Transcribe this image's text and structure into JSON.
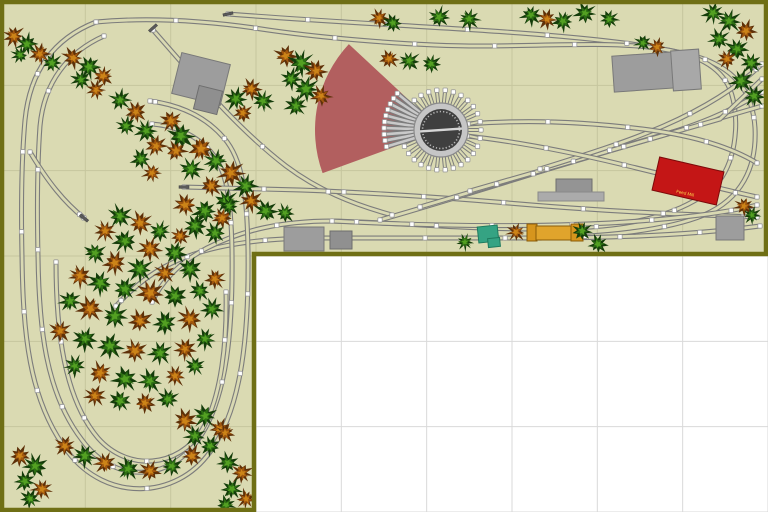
{
  "app": {
    "name": "Model railroad track plan with turntable and forest loop",
    "canvas": {
      "w": 768,
      "h": 512
    }
  },
  "board": {
    "fill": "#dadab2",
    "border_color": "#6f6f15",
    "grid_color": "#c6c69e",
    "outside_fill": "#ffffff",
    "outside_grid": "#d9d9d9",
    "cell": 85.333,
    "polygon": [
      [
        2,
        2
      ],
      [
        766,
        2
      ],
      [
        766,
        254
      ],
      [
        254,
        254
      ],
      [
        254,
        510
      ],
      [
        2,
        510
      ]
    ]
  },
  "track": {
    "rail": "#7c7c7c",
    "tie": "#d9d9b2",
    "stall_center": "#c9c9c9",
    "joint": {
      "size": 4.4,
      "fill": "#ffffff",
      "stroke": "#999999",
      "spacing": 80
    },
    "buffer_color": "#5a5a5a",
    "paths": [
      "M228,14 C330,22 440,27 520,33 C600,39 662,46 701,58 C739,71 753,96 755,128 C757,168 741,199 704,215 C665,231 600,237 540,238 L320,238 C268,238 222,243 186,257 C156,268 134,286 116,306",
      "M96,22 C150,17 210,21 268,30 C330,39 420,46 480,46 C540,46 602,42 648,47 C691,52 716,63 728,85 C740,109 738,152 722,177 C704,202 664,218 620,224 C570,231 500,229 460,227 C420,225 370,222 332,221 C282,221 242,230 207,248 C180,262 162,281 152,302",
      "M96,22 C55,38 30,70 25,120 C21,165 21,210 22,256 C23,330 28,400 68,452 C106,502 176,500 210,452 C243,407 249,330 248,250 C247,195 243,160 224,138 C206,117 180,105 150,101",
      "M104,36 C68,52 44,82 40,126 C37,168 37,212 38,256 C39,326 45,392 82,440 C114,484 168,482 198,440 C228,398 233,326 232,250 C231,200 227,170 211,152 C196,135 176,126 152,124",
      "M56,262 C56,330 64,398 98,438 C128,472 178,468 202,430 C222,396 227,340 226,292",
      "M153,30 C192,74 234,126 286,166 C318,190 352,204 392,215",
      "M30,152 C48,182 64,202 84,218",
      "M184,187 L300,190 C380,193 450,198 520,204 C590,210 660,214 757,217",
      "M332,221 C430,226 530,227 610,223 C680,219 730,212 757,205",
      "M380,220 C450,200 520,178 590,156 C650,138 710,121 762,106",
      "M420,207 C500,183 580,159 650,139 C695,126 730,112 762,92",
      "M470,191 C560,165 650,139 720,119 L762,79",
      "M540,169 C630,141 706,117 762,64",
      "M468,124 C530,119 590,122 650,130 C700,137 734,149 757,163",
      "M467,136 C520,142 570,152 620,164 C670,176 712,187 757,197",
      "M540,238 C630,238 700,234 760,226"
    ],
    "buffers": [
      {
        "x": 228,
        "y": 14,
        "deg": 78
      },
      {
        "x": 153,
        "y": 28,
        "deg": 48
      },
      {
        "x": 84,
        "y": 218,
        "deg": 130
      },
      {
        "x": 184,
        "y": 187,
        "deg": 90
      }
    ]
  },
  "roundhouse_fan": {
    "cx": 441,
    "cy": 130,
    "inner_r": 42,
    "outer_r": 126,
    "start_deg": 137,
    "end_deg": 200,
    "color": "#b25f5f"
  },
  "turntable": {
    "cx": 441,
    "cy": 130,
    "pit_r": 21,
    "ring_r": 27,
    "ring_fill": "#c6c6c6",
    "ring_stroke": "#8a8a8a",
    "pit_fill": "#3f3f3f",
    "tick_color": "#b9b9b9",
    "bridge_color": "#d6d6d6",
    "bridge_deg": 4,
    "stub_angles": [
      0,
      12,
      24,
      36,
      48,
      60,
      72,
      84,
      96,
      108,
      120,
      132,
      204,
      216,
      228,
      240,
      252,
      264,
      276,
      288,
      300,
      312,
      324,
      336,
      348
    ],
    "stub_r0": 27,
    "stub_r1": 40,
    "stall_angles": [
      140,
      146.3,
      152.7,
      159,
      165.3,
      171.7,
      178,
      184.3,
      190.7,
      197
    ],
    "stall_r0": 26,
    "stall_r1": 57
  },
  "buildings": [
    {
      "x": 176,
      "y": 58,
      "w": 50,
      "h": 42,
      "rot": 14,
      "fill": "#9d9d9d",
      "stroke": "#787878"
    },
    {
      "x": 196,
      "y": 88,
      "w": 24,
      "h": 24,
      "rot": 14,
      "fill": "#8f8f8f",
      "stroke": "#6e6e6e"
    },
    {
      "x": 613,
      "y": 54,
      "w": 62,
      "h": 36,
      "rot": -4,
      "fill": "#9d9d9d",
      "stroke": "#787878"
    },
    {
      "x": 672,
      "y": 50,
      "w": 28,
      "h": 40,
      "rot": -4,
      "fill": "#a8a8a8",
      "stroke": "#787878"
    },
    {
      "x": 556,
      "y": 179,
      "w": 36,
      "h": 15,
      "rot": 0,
      "fill": "#949494",
      "stroke": "#6e6e6e"
    },
    {
      "x": 538,
      "y": 192,
      "w": 66,
      "h": 9,
      "rot": 0,
      "fill": "#ababab",
      "stroke": "#8a8a8a"
    },
    {
      "x": 655,
      "y": 164,
      "w": 66,
      "h": 34,
      "rot": 13,
      "fill": "#c41616",
      "stroke": "#7c0a0a",
      "label": "Feed Mill",
      "label_color": "#ffd24a"
    },
    {
      "x": 284,
      "y": 227,
      "w": 40,
      "h": 24,
      "rot": 0,
      "fill": "#9d9d9d",
      "stroke": "#787878"
    },
    {
      "x": 330,
      "y": 231,
      "w": 22,
      "h": 18,
      "rot": 0,
      "fill": "#909090",
      "stroke": "#6e6e6e"
    },
    {
      "x": 478,
      "y": 226,
      "w": 20,
      "h": 16,
      "rot": -6,
      "fill": "#35a383",
      "stroke": "#1e7a5e"
    },
    {
      "x": 488,
      "y": 238,
      "w": 12,
      "h": 9,
      "rot": -6,
      "fill": "#35a383",
      "stroke": "#1e7a5e"
    },
    {
      "x": 527,
      "y": 224,
      "w": 10,
      "h": 17,
      "rot": 0,
      "fill": "#d6951d",
      "stroke": "#8a5c08"
    },
    {
      "x": 536,
      "y": 226,
      "w": 36,
      "h": 14,
      "rot": 0,
      "fill": "#e0a42c",
      "stroke": "#8a5c08"
    },
    {
      "x": 571,
      "y": 224,
      "w": 12,
      "h": 17,
      "rot": 0,
      "fill": "#d6951d",
      "stroke": "#8a5c08"
    },
    {
      "x": 716,
      "y": 216,
      "w": 28,
      "h": 24,
      "rot": 0,
      "fill": "#9d9d9d",
      "stroke": "#787878"
    }
  ],
  "trees": {
    "palettes": [
      [
        "#143c0a",
        "#2d6e14",
        "#53a022"
      ],
      [
        "#5e3008",
        "#a1570e",
        "#cc8418"
      ]
    ],
    "items": [
      [
        14,
        36,
        10,
        1
      ],
      [
        27,
        44,
        10,
        0
      ],
      [
        40,
        54,
        10,
        1
      ],
      [
        52,
        63,
        9,
        0
      ],
      [
        20,
        55,
        8,
        0
      ],
      [
        73,
        58,
        10,
        1
      ],
      [
        89,
        67,
        11,
        0
      ],
      [
        103,
        76,
        10,
        1
      ],
      [
        81,
        80,
        9,
        0
      ],
      [
        96,
        90,
        9,
        1
      ],
      [
        120,
        100,
        10,
        0
      ],
      [
        136,
        112,
        10,
        1
      ],
      [
        126,
        126,
        9,
        0
      ],
      [
        146,
        131,
        10,
        0
      ],
      [
        156,
        146,
        10,
        1
      ],
      [
        141,
        159,
        10,
        0
      ],
      [
        152,
        173,
        9,
        1
      ],
      [
        171,
        121,
        11,
        1
      ],
      [
        181,
        136,
        12,
        0
      ],
      [
        201,
        149,
        12,
        1
      ],
      [
        216,
        161,
        11,
        0
      ],
      [
        191,
        169,
        11,
        0
      ],
      [
        231,
        173,
        12,
        1
      ],
      [
        246,
        186,
        11,
        0
      ],
      [
        211,
        186,
        10,
        1
      ],
      [
        226,
        201,
        11,
        0
      ],
      [
        251,
        201,
        10,
        1
      ],
      [
        266,
        211,
        11,
        0
      ],
      [
        176,
        151,
        10,
        1
      ],
      [
        236,
        99,
        11,
        0
      ],
      [
        251,
        89,
        10,
        1
      ],
      [
        263,
        101,
        10,
        0
      ],
      [
        243,
        113,
        9,
        1
      ],
      [
        185,
        205,
        11,
        1
      ],
      [
        205,
        211,
        12,
        0
      ],
      [
        222,
        218,
        10,
        1
      ],
      [
        195,
        226,
        11,
        0
      ],
      [
        215,
        233,
        10,
        0
      ],
      [
        180,
        236,
        9,
        1
      ],
      [
        229,
        206,
        9,
        0
      ],
      [
        286,
        56,
        11,
        1
      ],
      [
        301,
        63,
        12,
        0
      ],
      [
        316,
        71,
        11,
        1
      ],
      [
        291,
        79,
        10,
        0
      ],
      [
        306,
        89,
        12,
        0
      ],
      [
        321,
        96,
        10,
        1
      ],
      [
        296,
        106,
        10,
        0
      ],
      [
        389,
        59,
        9,
        1
      ],
      [
        409,
        61,
        10,
        0
      ],
      [
        431,
        64,
        9,
        0
      ],
      [
        379,
        18,
        9,
        1
      ],
      [
        393,
        23,
        9,
        0
      ],
      [
        439,
        17,
        10,
        0
      ],
      [
        469,
        19,
        10,
        0
      ],
      [
        531,
        15,
        10,
        0
      ],
      [
        547,
        19,
        9,
        1
      ],
      [
        563,
        21,
        10,
        0
      ],
      [
        585,
        13,
        10,
        0
      ],
      [
        609,
        19,
        9,
        0
      ],
      [
        643,
        43,
        8,
        0
      ],
      [
        657,
        47,
        9,
        1
      ],
      [
        713,
        13,
        10,
        0
      ],
      [
        729,
        21,
        11,
        0
      ],
      [
        746,
        31,
        10,
        1
      ],
      [
        719,
        39,
        10,
        0
      ],
      [
        737,
        49,
        11,
        0
      ],
      [
        751,
        63,
        10,
        0
      ],
      [
        727,
        59,
        9,
        1
      ],
      [
        741,
        81,
        11,
        0
      ],
      [
        754,
        96,
        10,
        0
      ],
      [
        285,
        213,
        9,
        0
      ],
      [
        465,
        242,
        8,
        0
      ],
      [
        516,
        232,
        9,
        1
      ],
      [
        582,
        231,
        9,
        0
      ],
      [
        598,
        244,
        9,
        0
      ],
      [
        744,
        206,
        9,
        1
      ],
      [
        752,
        215,
        8,
        0
      ],
      [
        120,
        216,
        11,
        0
      ],
      [
        140,
        223,
        11,
        1
      ],
      [
        160,
        231,
        10,
        0
      ],
      [
        105,
        231,
        10,
        1
      ],
      [
        125,
        241,
        11,
        0
      ],
      [
        150,
        249,
        12,
        1
      ],
      [
        175,
        253,
        11,
        0
      ],
      [
        95,
        253,
        10,
        0
      ],
      [
        115,
        263,
        11,
        1
      ],
      [
        140,
        269,
        12,
        0
      ],
      [
        165,
        273,
        10,
        1
      ],
      [
        190,
        269,
        11,
        0
      ],
      [
        80,
        276,
        11,
        1
      ],
      [
        100,
        283,
        12,
        0
      ],
      [
        125,
        289,
        11,
        0
      ],
      [
        150,
        293,
        12,
        1
      ],
      [
        175,
        296,
        11,
        0
      ],
      [
        200,
        291,
        10,
        0
      ],
      [
        215,
        279,
        10,
        1
      ],
      [
        70,
        301,
        10,
        0
      ],
      [
        90,
        309,
        12,
        1
      ],
      [
        115,
        316,
        12,
        0
      ],
      [
        140,
        321,
        11,
        1
      ],
      [
        165,
        323,
        11,
        0
      ],
      [
        190,
        319,
        11,
        1
      ],
      [
        212,
        309,
        10,
        0
      ],
      [
        60,
        331,
        10,
        1
      ],
      [
        85,
        339,
        11,
        0
      ],
      [
        110,
        346,
        12,
        0
      ],
      [
        135,
        351,
        11,
        1
      ],
      [
        160,
        353,
        11,
        0
      ],
      [
        185,
        349,
        10,
        1
      ],
      [
        205,
        339,
        10,
        0
      ],
      [
        75,
        366,
        10,
        0
      ],
      [
        100,
        373,
        11,
        1
      ],
      [
        125,
        379,
        12,
        0
      ],
      [
        150,
        381,
        11,
        0
      ],
      [
        175,
        376,
        10,
        1
      ],
      [
        195,
        366,
        9,
        0
      ],
      [
        95,
        396,
        10,
        1
      ],
      [
        120,
        401,
        11,
        0
      ],
      [
        145,
        403,
        10,
        1
      ],
      [
        168,
        399,
        10,
        0
      ],
      [
        185,
        421,
        11,
        1
      ],
      [
        205,
        416,
        11,
        0
      ],
      [
        220,
        429,
        10,
        1
      ],
      [
        195,
        436,
        10,
        0
      ],
      [
        65,
        446,
        10,
        1
      ],
      [
        85,
        456,
        11,
        0
      ],
      [
        105,
        463,
        10,
        1
      ],
      [
        128,
        469,
        11,
        0
      ],
      [
        150,
        471,
        10,
        1
      ],
      [
        172,
        466,
        10,
        0
      ],
      [
        192,
        456,
        10,
        1
      ],
      [
        210,
        446,
        10,
        0
      ],
      [
        225,
        433,
        9,
        1
      ],
      [
        20,
        456,
        10,
        1
      ],
      [
        35,
        466,
        11,
        0
      ],
      [
        25,
        481,
        10,
        0
      ],
      [
        42,
        489,
        10,
        1
      ],
      [
        30,
        499,
        9,
        0
      ],
      [
        228,
        463,
        10,
        0
      ],
      [
        242,
        473,
        10,
        1
      ],
      [
        232,
        489,
        10,
        0
      ],
      [
        246,
        499,
        9,
        1
      ],
      [
        226,
        505,
        9,
        0
      ]
    ]
  }
}
